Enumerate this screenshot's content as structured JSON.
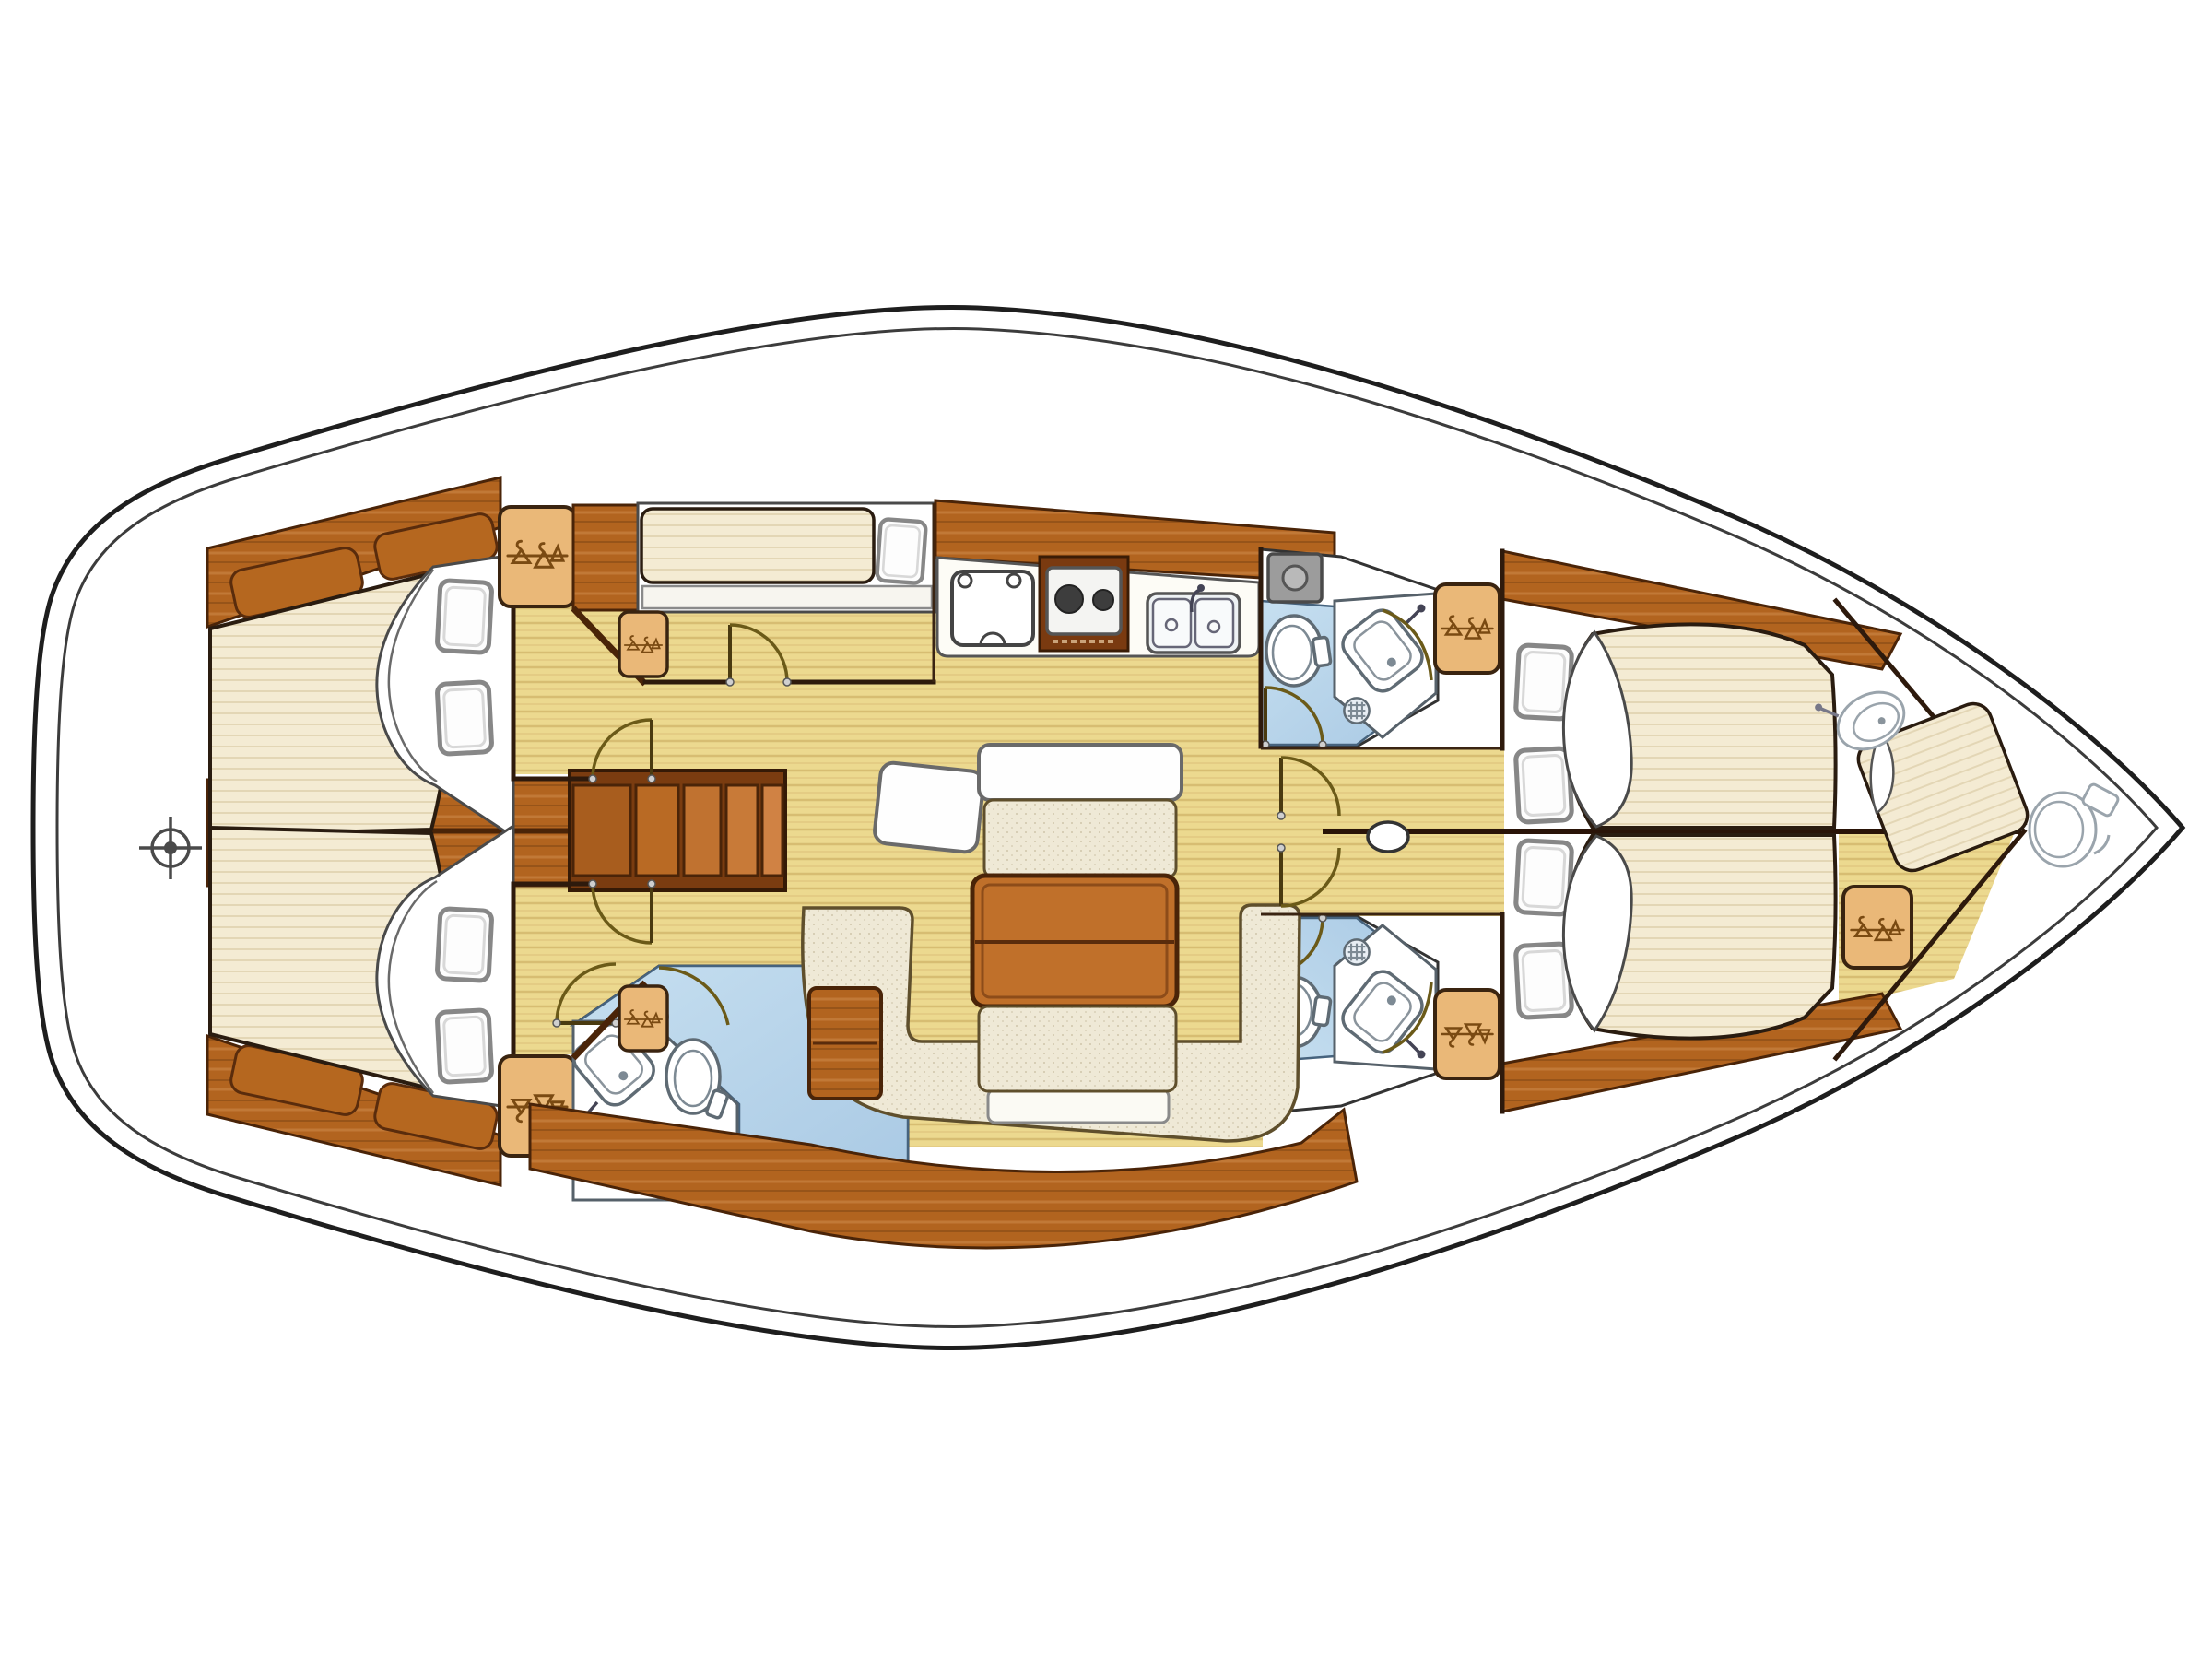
{
  "document": {
    "title": "Sailing yacht interior layout — top-down floor plan, bow pointing right",
    "type": "boat-floor-plan",
    "text_labels": [],
    "orientation": "bow-right"
  },
  "colors": {
    "background": "#ffffff",
    "hull_outline": "#1e1e1e",
    "inner_hull_outline": "#3c3c3c",
    "deck_white": "#ffffff",
    "mahogany": "#b2641f",
    "mahogany_dark": "#8a4a15",
    "mahogany_border": "#4a2408",
    "light_wood_locker": "#eab878",
    "locker_border": "#3a2410",
    "hanger_stroke": "#7a4a12",
    "floor_yellow": "#ecd98f",
    "floor_grain": "#d9c06a",
    "mattress_cream": "#f4ebd3",
    "mattress_border": "#2a1c10",
    "settee_cream": "#efe9d6",
    "settee_border": "#5f4f2c",
    "table_wood": "#c0702a",
    "head_blue": "#c6dff0",
    "head_blue_deep": "#a9c9e4",
    "shower_gray": "#9c9c9c",
    "shower_gray_border": "#4a4a4a",
    "fixture_outline": "#5f6b74",
    "stove_burner": "#3d3d3d"
  },
  "rooms": [
    {
      "id": "aft-cabin-port",
      "name": "Aft double cabin (port)",
      "fixtures": [
        "double berth",
        "2 pillows",
        "hull shelf with 2 stowage bins",
        "hanging locker",
        "entry door"
      ]
    },
    {
      "id": "aft-cabin-starboard",
      "name": "Aft double cabin (starboard)",
      "fixtures": [
        "double berth",
        "2 pillows",
        "hull shelf with 2 stowage bins",
        "hanging locker",
        "entry door"
      ]
    },
    {
      "id": "engine-compartment",
      "name": "Engine / cockpit sole between aft cabins",
      "fixtures": [
        "planked panels"
      ]
    },
    {
      "id": "companionway",
      "name": "Companionway steps",
      "fixtures": [
        "4 treads"
      ]
    },
    {
      "id": "bunk-cabin",
      "name": "Amidships single-berth cabin",
      "fixtures": [
        "single berth",
        "pillow",
        "shelf",
        "hanging locker",
        "entry door"
      ]
    },
    {
      "id": "aft-head",
      "name": "Aft head (starboard)",
      "fixtures": [
        "toilet",
        "wash basin",
        "shower tray",
        "shower drain",
        "2 doors"
      ]
    },
    {
      "id": "galley",
      "name": "Galley",
      "fixtures": [
        "top-loading fridge",
        "2-burner stove",
        "double sink with faucet"
      ]
    },
    {
      "id": "salon",
      "name": "Salon / dinette",
      "fixtures": [
        "drop-leaf table",
        "2 white table leaves",
        "U-shaped settee",
        "2 bench cushions",
        "side cabinet",
        "chair leaf"
      ]
    },
    {
      "id": "forward-head-port",
      "name": "Forward head (port)",
      "fixtures": [
        "toilet",
        "wash basin",
        "shower tray",
        "shower drain",
        "2 doors"
      ]
    },
    {
      "id": "forward-head-starboard",
      "name": "Forward head (starboard)",
      "fixtures": [
        "toilet",
        "wash basin",
        "shower drain",
        "2 doors"
      ]
    },
    {
      "id": "forward-corridor",
      "name": "Corridor to forward cabins",
      "fixtures": [
        "mast foot",
        "2 cabin doors",
        "centerline bulkhead"
      ]
    },
    {
      "id": "forward-cabin-port",
      "name": "Forward double cabin (port)",
      "fixtures": [
        "V-berth",
        "2 pillows",
        "hull shelf",
        "hanging locker"
      ]
    },
    {
      "id": "forward-cabin-starboard",
      "name": "Forward double cabin (starboard)",
      "fixtures": [
        "V-berth",
        "2 pillows",
        "hull shelf",
        "hanging locker"
      ]
    },
    {
      "id": "forepeak",
      "name": "Forepeak crew cabin",
      "fixtures": [
        "berth cushion",
        "wash basin",
        "hanging locker",
        "marine toilet at bow"
      ]
    },
    {
      "id": "stern",
      "name": "Stern platform",
      "fixtures": [
        "rudder-stock crosshair symbol"
      ]
    }
  ],
  "counts": {
    "double_cabins": 4,
    "single_cabins": 1,
    "forepeak_cabin": 1,
    "heads": 3,
    "bow_toilet": 1,
    "hanging_lockers": 8,
    "pillows": 9,
    "companionway_treads": 4
  },
  "symbols": {
    "crosshair": "rudder-stock / steering position marker",
    "hanger_zigzag": "hanging locker (wardrobe) symbol",
    "quarter_arc": "door swing",
    "circle_crosshatch": "shower drain",
    "oval_on_centerline": "mast"
  }
}
